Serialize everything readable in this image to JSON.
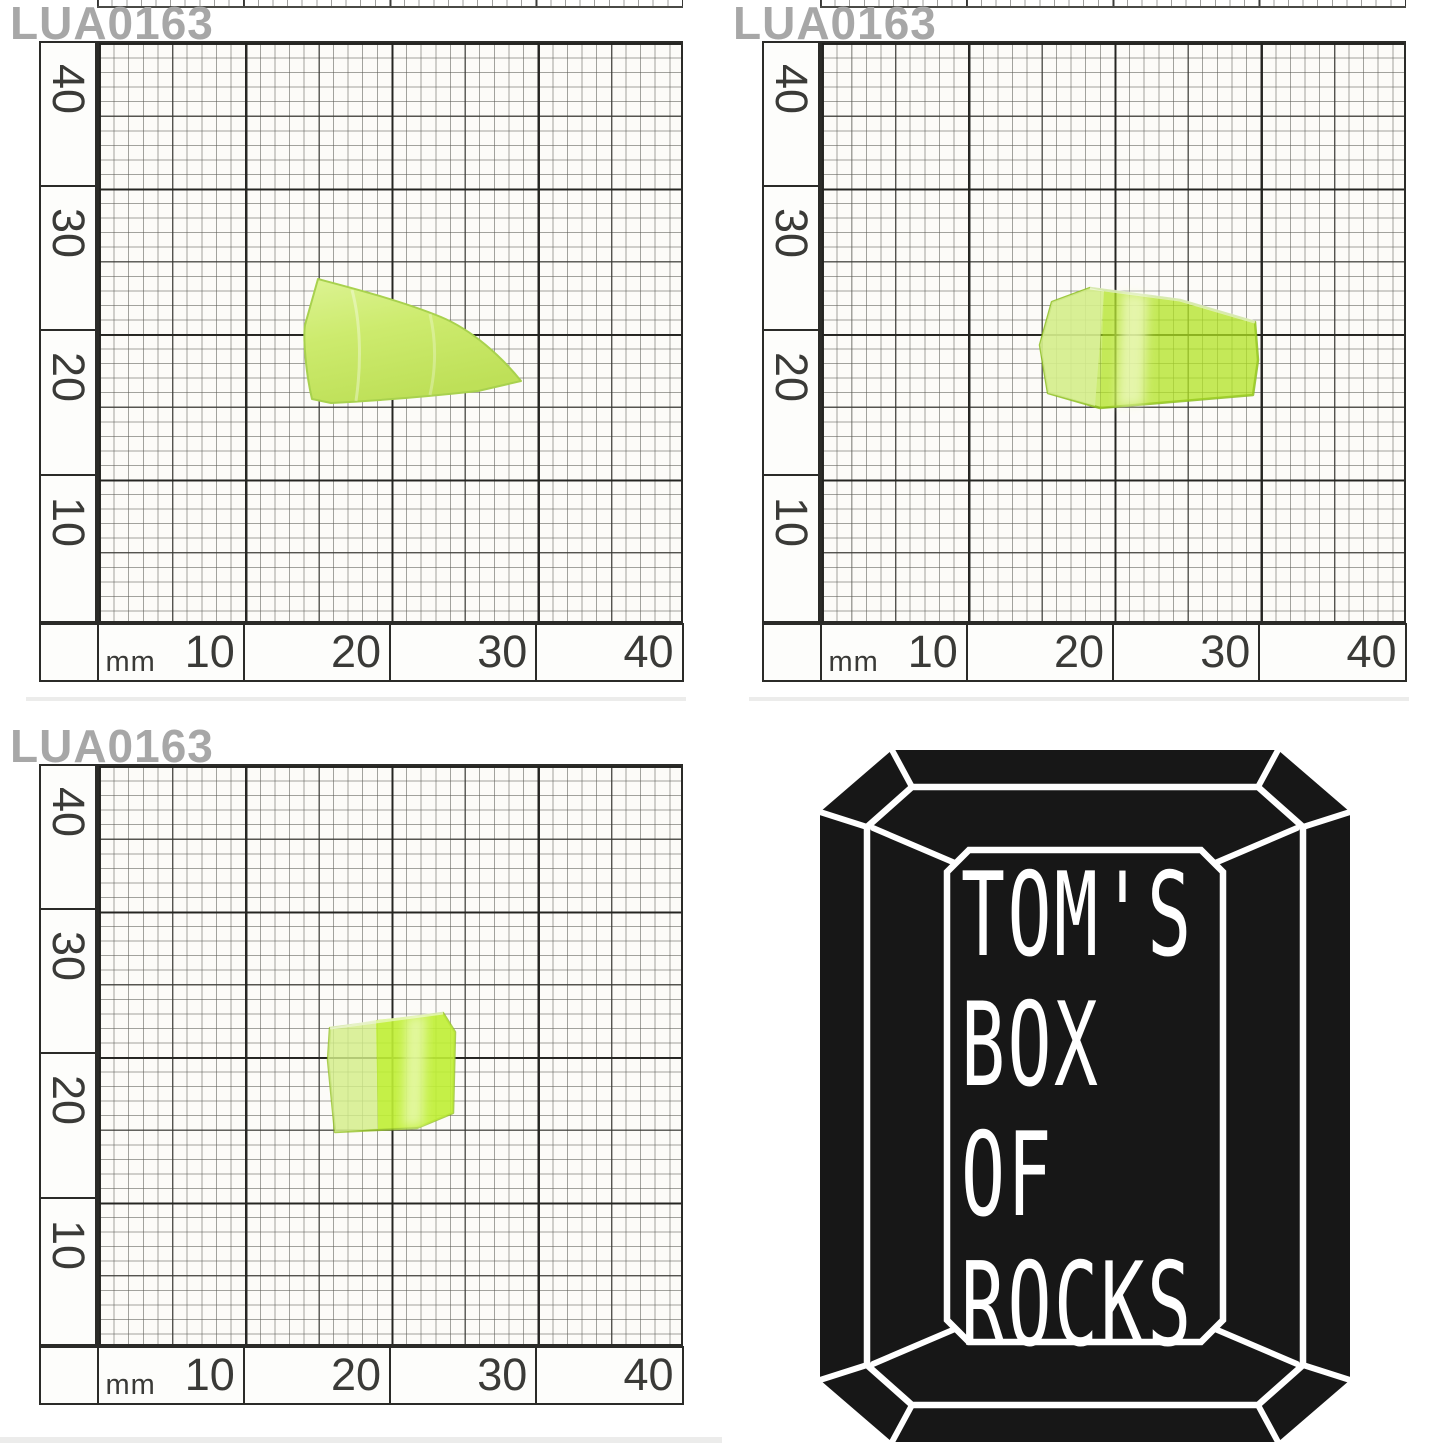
{
  "specimen": {
    "id": "LUA0163"
  },
  "scale": {
    "unit": "mm",
    "v": [
      "40",
      "30",
      "20",
      "10"
    ],
    "h": [
      "10",
      "20",
      "30",
      "40"
    ]
  },
  "logo": {
    "lines": [
      "TOM'S",
      "BOX",
      "OF",
      "ROCKS"
    ],
    "shape": "emerald-cut-gem"
  },
  "colors": {
    "stone_opaque": "#cbe96e",
    "stone_bright": "#b5e437",
    "stone_light_facet": "#ddf0a0",
    "stone_highlight": "#f4fbd8",
    "grid_line": "#2b2b28",
    "label_gray": "#a7a7a7",
    "logo_black": "#171717",
    "logo_line_white": "#ffffff"
  }
}
